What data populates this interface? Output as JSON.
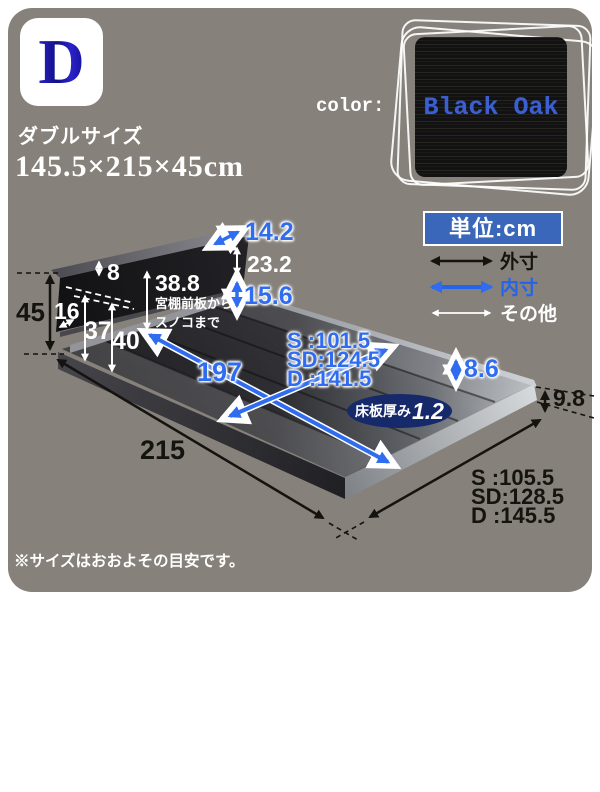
{
  "badge": {
    "letter": "D"
  },
  "header": {
    "size_name": "ダブルサイズ",
    "size_dims": "145.5×215×45cm"
  },
  "color_swatch": {
    "label": "color:",
    "name": "Black Oak"
  },
  "legend": {
    "unit": "単位:cm",
    "items": [
      {
        "label": "外寸",
        "color": "#15130f"
      },
      {
        "label": "内寸",
        "color": "#2563e8"
      },
      {
        "label": "その他",
        "color": "#ffffff"
      }
    ]
  },
  "dimensions": {
    "total_height": "45",
    "headboard_top_panel": "8",
    "shelf_depth": "16",
    "height_37": "37",
    "height_40": "40",
    "shelf_to_slat_value": "38.8",
    "shelf_to_slat_note1": "宮棚前板から",
    "shelf_to_slat_note2": "スノコまで",
    "headboard_top_depth": "14.2",
    "headboard_upper_height": "23.2",
    "headboard_lower_height": "15.6",
    "inner_width_s": "S :101.5",
    "inner_width_sd": "SD:124.5",
    "inner_width_d": "D :141.5",
    "inner_length": "197",
    "frame_inner_height": "8.6",
    "frame_outer_height": "9.8",
    "outer_length": "215",
    "outer_width_s": "S :105.5",
    "outer_width_sd": "SD:128.5",
    "outer_width_d": "D :145.5",
    "floor_board_label": "床板厚み",
    "floor_board_value": "1.2"
  },
  "notes": {
    "lines": [
      "※サイズはおおよその目安です。",
      "※曲線部や若干の個体差などにより、",
      "表記と多少の差異が生じることがございます。",
      "あらかじめご了承ください。"
    ]
  },
  "colors": {
    "background": "#86817a",
    "accent_blue": "#2f6cf0",
    "unit_box_blue": "#3a67ba",
    "ellipse_navy": "#16296b",
    "badge_letter_blue": "#1d18b0",
    "swatch_text_blue": "#3b5fd0"
  }
}
